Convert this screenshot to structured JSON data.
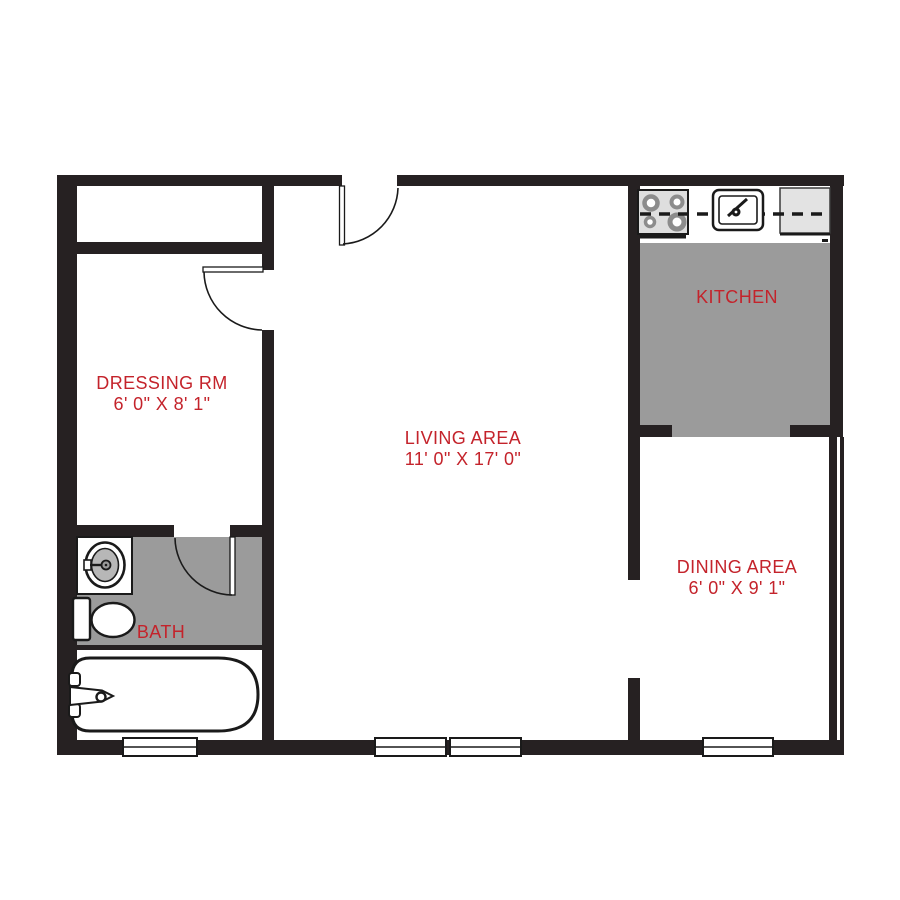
{
  "title": "Apartment floor plan",
  "colors": {
    "wall": "#262122",
    "label": "#c4232b",
    "floor": "#9b9b9b",
    "appliance": "#dedede",
    "burner": "#8c8c8c",
    "sink_basin": "#b7b7b7"
  },
  "floorplan": {
    "rooms": [
      {
        "name": "DRESSING RM",
        "dimensions": "6' 0\" X 8' 1\""
      },
      {
        "name": "LIVING AREA",
        "dimensions": "11' 0\" X 17' 0\""
      },
      {
        "name": "KITCHEN",
        "dimensions": ""
      },
      {
        "name": "DINING AREA",
        "dimensions": "6' 0\" X 9' 1\""
      },
      {
        "name": "BATH",
        "dimensions": ""
      }
    ],
    "fixtures": [
      "stove",
      "kitchen-sink",
      "refrigerator-counter",
      "bathroom-sink",
      "toilet",
      "bathtub"
    ],
    "door_count": 3,
    "window_count": 4
  }
}
